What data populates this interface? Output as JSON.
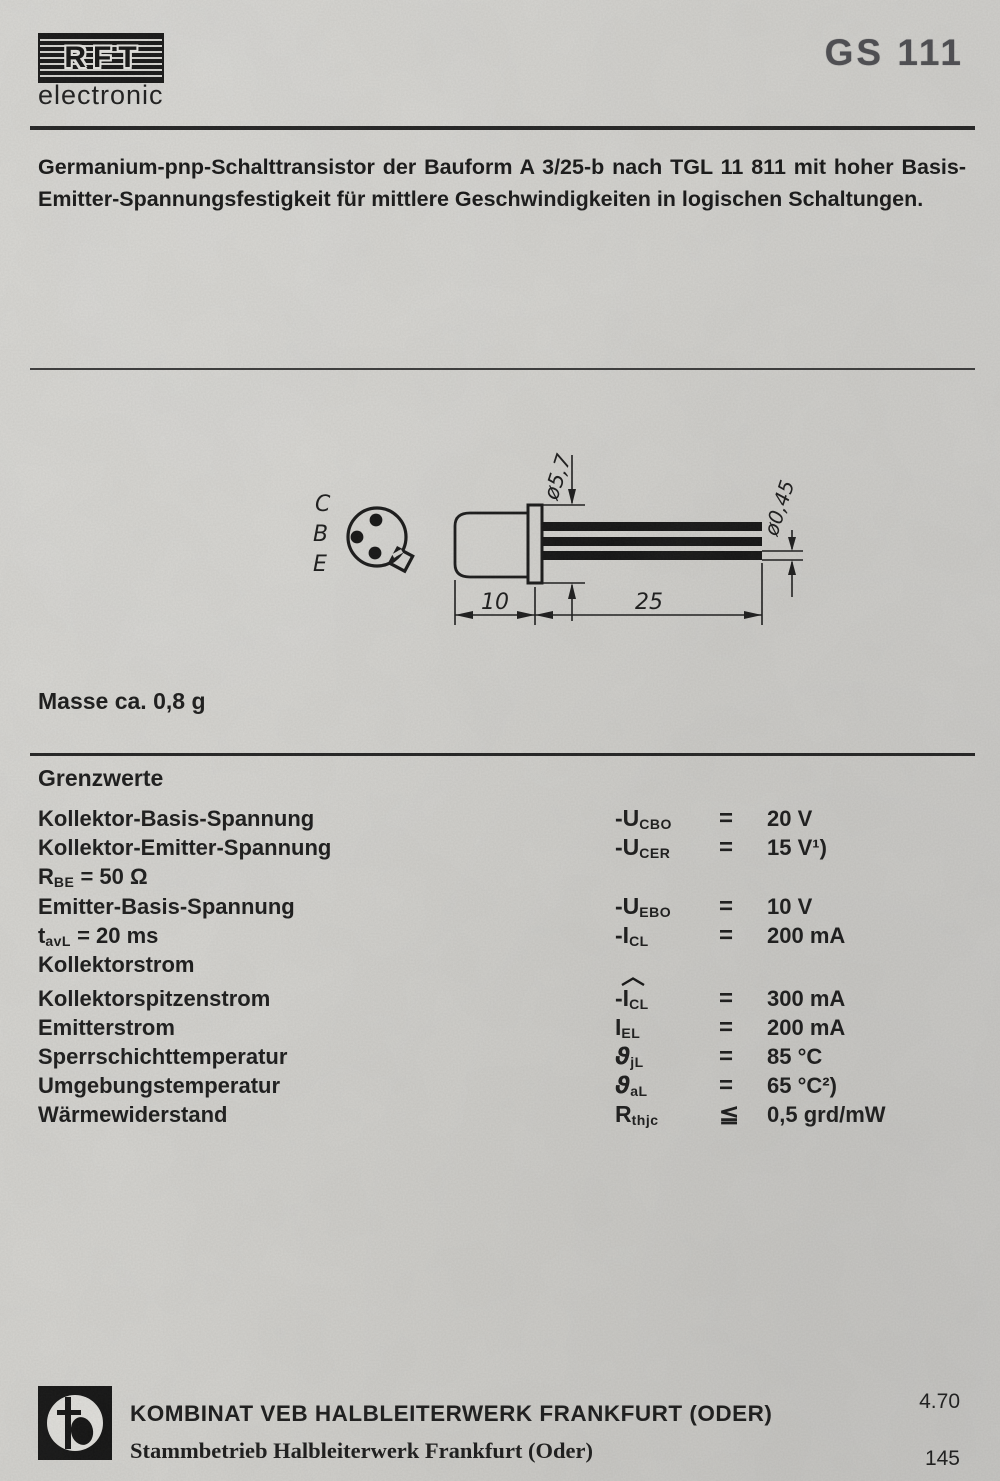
{
  "header": {
    "brand": "RFT",
    "brand_sub": "electronic",
    "part_number": "GS 111"
  },
  "description": {
    "line1": "Germanium-pnp-Schalttransistor der Bauform A 3/25-b nach TGL 11 811 mit hoher Basis-",
    "line2": "Emitter-Spannungsfestigkeit für mittlere Geschwindigkeiten in logischen Schaltungen."
  },
  "drawing": {
    "pin_labels": [
      "C",
      "B",
      "E"
    ],
    "dim_flange_dia": "ø5,7",
    "dim_lead_dia": "ø0,45",
    "dim_body_len": "10",
    "dim_lead_len": "25"
  },
  "mass_note": "Masse ca. 0,8 g",
  "limits": {
    "heading": "Grenzwerte",
    "rows": [
      {
        "label": "Kollektor-Basis-Spannung",
        "sym": "-U",
        "sym_sub": "CBO",
        "rel": "=",
        "val": "20 V"
      },
      {
        "label": "Kollektor-Emitter-Spannung",
        "sym": "-U",
        "sym_sub": "CER",
        "rel": "=",
        "val": "15 V¹)"
      },
      {
        "label": "R",
        "label_sub": "BE",
        "label_rest": " =  50 Ω"
      },
      {
        "label": "Emitter-Basis-Spannung",
        "sym": "-U",
        "sym_sub": "EBO",
        "rel": "=",
        "val": "10 V"
      },
      {
        "label": "t",
        "label_sub": "avL",
        "label_rest": " =  20 ms",
        "sym": "-I",
        "sym_sub": "CL",
        "rel": "=",
        "val": "200 mA"
      },
      {
        "label": "Kollektorstrom"
      },
      {
        "label": "Kollektorspitzenstrom",
        "sym": "-I",
        "sym_sub": "CL",
        "rel": "=",
        "val": "300 mA",
        "hat": true
      },
      {
        "label": "Emitterstrom",
        "sym": "I",
        "sym_sub": "EL",
        "rel": "=",
        "val": "200 mA"
      },
      {
        "label": "Sperrschichttemperatur",
        "sym": "ϑ",
        "sym_sub": "jL",
        "rel": "=",
        "val": "85 °C"
      },
      {
        "label": "Umgebungstemperatur",
        "sym": "ϑ",
        "sym_sub": "aL",
        "rel": "=",
        "val": "65 °C²)"
      },
      {
        "label": "Wärmewiderstand",
        "sym": "R",
        "sym_sub": "thjc",
        "rel": "≦",
        "val": "0,5 grd/mW"
      }
    ]
  },
  "footer": {
    "company_line1": "KOMBINAT VEB HALBLEITERWERK FRANKFURT (ODER)",
    "company_line2": "Stammbetrieb Halbleiterwerk Frankfurt (Oder)",
    "date_code": "4.70",
    "page_number": "145"
  },
  "colors": {
    "paper": "#d5d4d0",
    "ink": "#1a1a1a",
    "part_number_gray": "#4c4c50"
  }
}
